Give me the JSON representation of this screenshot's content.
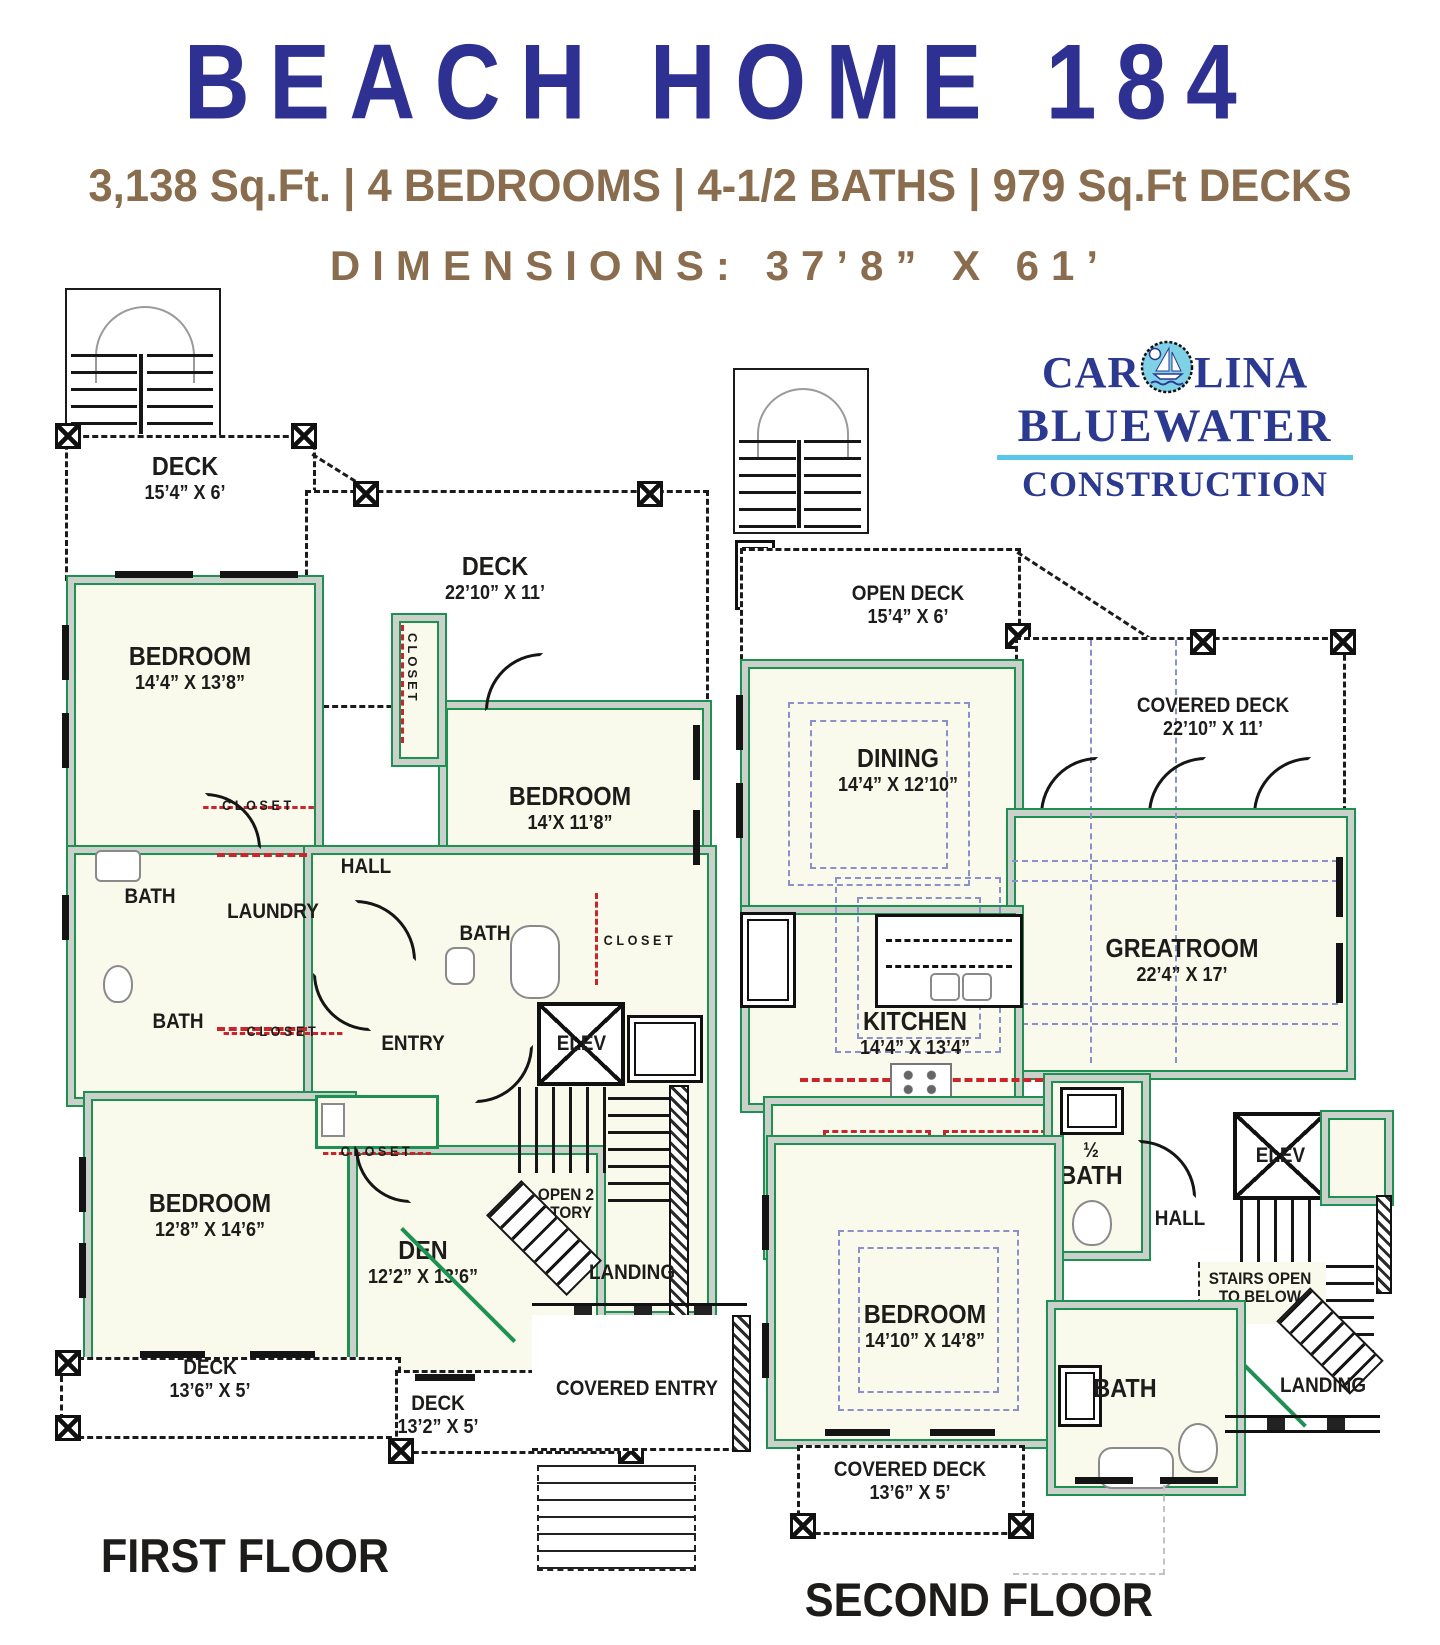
{
  "header": {
    "title": "BEACH HOME 184",
    "specs": "3,138 Sq.Ft. | 4 BEDROOMS | 4-1/2 BATHS | 979 Sq.Ft DECKS",
    "dimensions": "DIMENSIONS: 37’8” X 61’"
  },
  "logo": {
    "line1_pre": "CAR",
    "line1_post": "LINA",
    "line2": "BLUEWATER",
    "line3": "CONSTRUCTION"
  },
  "colors": {
    "title_blue": "#2e3192",
    "accent_brown": "#8a6d4e",
    "wall_green": "#1d9152",
    "room_fill": "#fafaec",
    "closet_red": "#c9252c",
    "ceiling_blue": "#8b90cc",
    "logo_navy": "#2b3990",
    "logo_cyan": "#59c7e8"
  },
  "first_floor": {
    "label": "FIRST FLOOR",
    "deck_top": {
      "name": "DECK",
      "dims": "15’4” X 6’"
    },
    "bedroom_top": {
      "name": "BEDROOM",
      "dims": "14’4” X 13’8”"
    },
    "deck_right": {
      "name": "DECK",
      "dims": "22’10” X 11’"
    },
    "bedroom_right": {
      "name": "BEDROOM",
      "dims": "14’X 11’8”"
    },
    "closet_vertical": "CLOSET",
    "hall": "HALL",
    "closet_top": "CLOSET",
    "bath_left": "BATH",
    "laundry": "LAUNDRY",
    "bath_mid": "BATH",
    "closet_mid": "CLOSET",
    "bath_center": "BATH",
    "closet_right": "CLOSET",
    "entry": "ENTRY",
    "elevator": "ELEV",
    "bedroom_bottom": {
      "name": "BEDROOM",
      "dims": "12’8” X 14’6”"
    },
    "closet_small": "CLOSET",
    "den": {
      "name": "DEN",
      "dims": "12’2” X 13’6”"
    },
    "open_two_story": "OPEN 2 STORY",
    "landing": "LANDING",
    "deck_bottom_left": {
      "name": "DECK",
      "dims": "13’6” X 5’"
    },
    "deck_bottom_center": {
      "name": "DECK",
      "dims": "13’2” X 5’"
    },
    "covered_entry": "COVERED ENTRY"
  },
  "second_floor": {
    "label": "SECOND FLOOR",
    "open_deck": {
      "name": "OPEN DECK",
      "dims": "15’4” X 6’"
    },
    "dining": {
      "name": "DINING",
      "dims": "14’4” X 12’10”"
    },
    "covered_deck_top": {
      "name": "COVERED DECK",
      "dims": "22’10” X 11’"
    },
    "greatroom": {
      "name": "GREATROOM",
      "dims": "22’4” X 17’"
    },
    "kitchen": {
      "name": "KITCHEN",
      "dims": "14’4” X 13’4”"
    },
    "closet_left": "CLOSET",
    "closet_right": "CLOSET",
    "half_bath_fraction": "½",
    "half_bath": "BATH",
    "elevator": "ELEV",
    "hall": "HALL",
    "bedroom": {
      "name": "BEDROOM",
      "dims": "14’10” X 14’8”"
    },
    "stairs_open_line1": "STAIRS OPEN",
    "stairs_open_line2": "TO BELOW",
    "bath": "BATH",
    "landing": "LANDING",
    "covered_deck_bottom": {
      "name": "COVERED DECK",
      "dims": "13’6” X 5’"
    }
  }
}
